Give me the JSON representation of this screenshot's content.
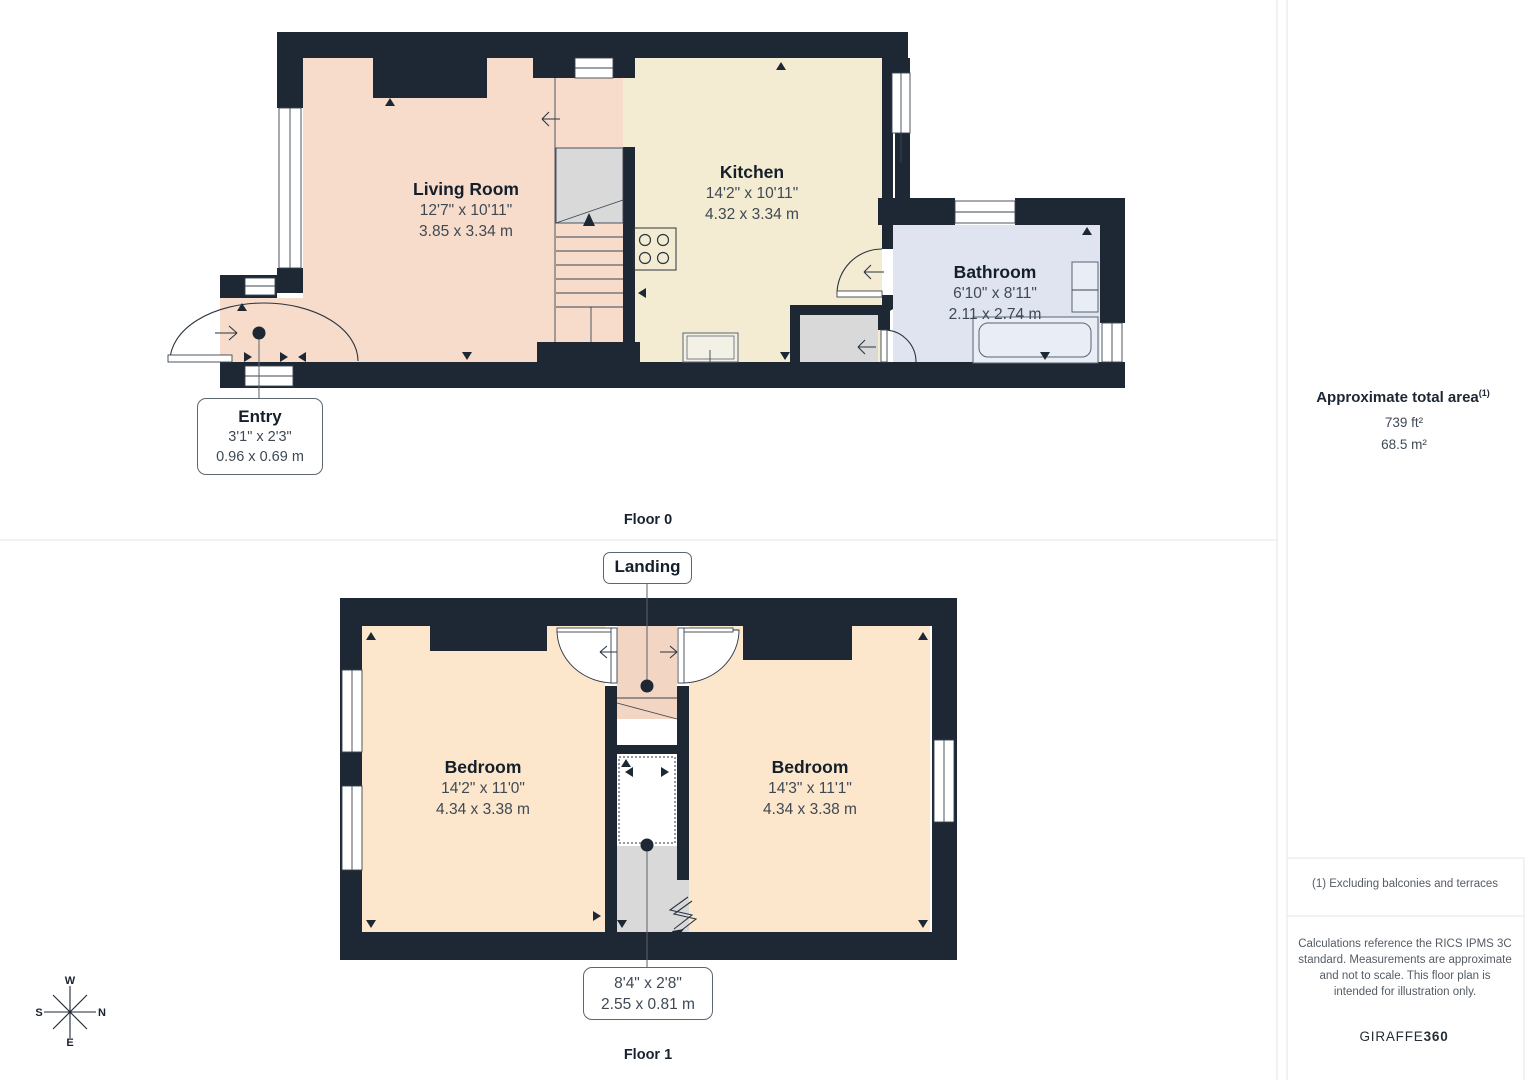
{
  "page": {
    "floor0_label": "Floor 0",
    "floor1_label": "Floor 1"
  },
  "floor0": {
    "rooms": {
      "living_room": {
        "name": "Living Room",
        "imperial": "12'7\" x 10'11\"",
        "metric": "3.85 x 3.34 m"
      },
      "kitchen": {
        "name": "Kitchen",
        "imperial": "14'2\" x 10'11\"",
        "metric": "4.32 x 3.34 m"
      },
      "bathroom": {
        "name": "Bathroom",
        "imperial": "6'10\" x 8'11\"",
        "metric": "2.11 x 2.74 m"
      },
      "entry": {
        "name": "Entry",
        "imperial": "3'1\" x 2'3\"",
        "metric": "0.96 x 0.69 m"
      }
    }
  },
  "floor1": {
    "landing": {
      "name": "Landing"
    },
    "rooms": {
      "bedroom_left": {
        "name": "Bedroom",
        "imperial": "14'2\" x 11'0\"",
        "metric": "4.34 x 3.38 m"
      },
      "bedroom_right": {
        "name": "Bedroom",
        "imperial": "14'3\" x 11'1\"",
        "metric": "4.34 x 3.38 m"
      },
      "stairs": {
        "imperial": "8'4\" x 2'8\"",
        "metric": "2.55 x 0.81 m"
      }
    }
  },
  "sidebar": {
    "area_title": "Approximate total area",
    "area_footnote_marker": "(1)",
    "area_imperial": "739 ft²",
    "area_metric": "68.5 m²",
    "footnote": "(1) Excluding balconies and terraces",
    "disclaimer": "Calculations reference the RICS IPMS 3C standard. Measurements are approximate and not to scale. This floor plan is intended for illustration only.",
    "brand_name": "GIRAFFE",
    "brand_suffix": "360"
  },
  "compass": {
    "north": "N",
    "south": "S",
    "east": "E",
    "west": "W"
  },
  "colors": {
    "wall": "#1d2834",
    "living": "#f7dccb",
    "kitchen": "#f4ecd2",
    "bathroom": "#dfe4f0",
    "bedroom": "#fce7cc",
    "landing": "#f2d5c3",
    "stairs_grey": "#d9d9d9"
  }
}
